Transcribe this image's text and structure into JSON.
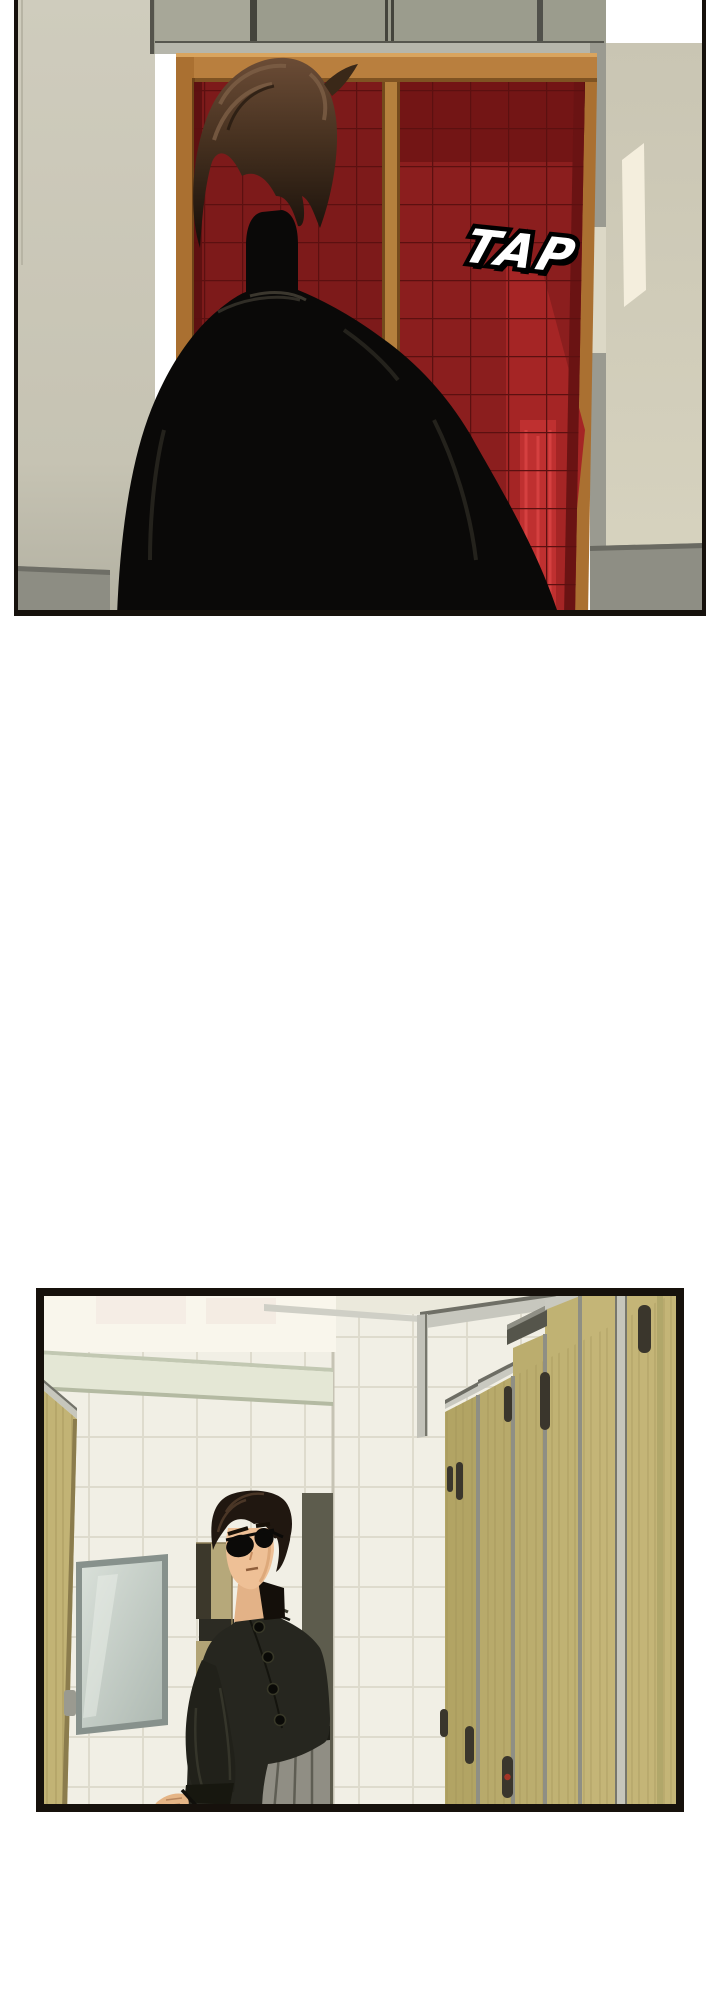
{
  "page": {
    "kind": "webtoon-comic-strip",
    "background": "#ffffff"
  },
  "panel1": {
    "description": "Back view of a dark-haired man in a black jacket standing before a red quilted double door with an orange wooden frame; light falls on the beige wall at right.",
    "sfx": {
      "text": "TAP",
      "fill": "#ffffff",
      "outline": "#000000"
    }
  },
  "panel2": {
    "description": "A man wearing round sunglasses and a dark mandarin-collar jacket steps out beside a mirror and wall cabinet in a white tiled restroom; a row of tan wooden toilet stalls with metal locks recedes to the right."
  },
  "palette": {
    "page_bg": "#ffffff",
    "panel_border": "#16110c",
    "wall_beige": "#cbc8b7",
    "wall_bright": "#d7d3c0",
    "baseboard_grey": "#8d8d83",
    "transom_grey": "#9b9c8d",
    "door_frame_orange": "#b07334",
    "door_red": "#8b1e1e",
    "door_red_lit": "#bf3030",
    "quilt_line": "#5c1010",
    "silhouette_black": "#0a0908",
    "hair_brown": "#54392b",
    "sfx_fill": "#ffffff",
    "sfx_outline": "#000000",
    "ceiling_cream": "#f9f6ec",
    "beam_green": "#e4e7d5",
    "tile_white": "#f1efe5",
    "grout": "#dedbcd",
    "stall_wood": "#beb071",
    "stall_silver": "#c7c7be",
    "lock_dark": "#3a362c",
    "mirror_glass": "#c9d3cc",
    "cabinet_tan": "#b4a677",
    "skin": "#eec096",
    "jacket_olive": "#26261f",
    "trouser_grey": "#908e84",
    "indicator_red": "#a33426"
  }
}
